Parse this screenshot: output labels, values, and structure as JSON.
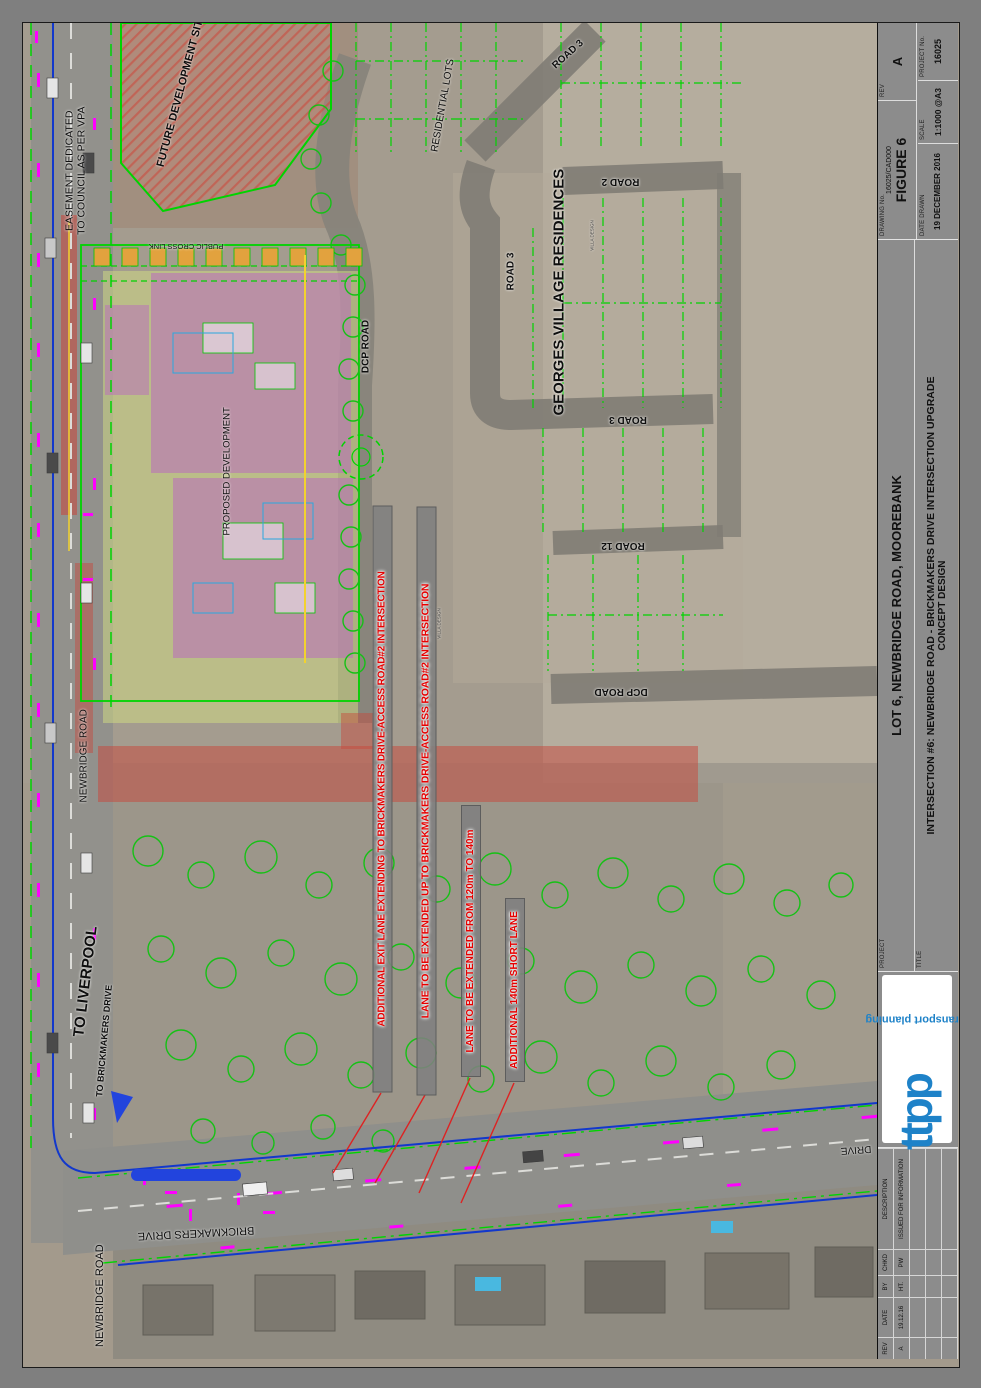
{
  "map": {
    "labels": {
      "easement": "EASEMENT DEDICATED TO COUNCIL AS PER VPA",
      "future_site": "FUTURE DEVELOPMENT SITE",
      "public_cross_link": "PUBLIC CROSS LINK",
      "residential_lots": "RESIDENTIAL LOTS",
      "road3_top": "ROAD 3",
      "road2": "ROAD 2",
      "road3_mid": "ROAD 3",
      "georges": "GEORGES VILLAGE RESIDENCES",
      "road3_low": "ROAD 3",
      "road12": "ROAD 12",
      "dcp_road_east": "DCP ROAD",
      "dcp_road_north": "DCP ROAD",
      "proposed_dev": "PROPOSED DEVELOPMENT",
      "newbridge_mid": "NEWBRIDGE ROAD",
      "to_liverpool": "TO LIVERPOOL",
      "to_brickmakers": "TO BRICKMAKERS DRIVE",
      "brickmakers_drive": "BRICKMAKERS DRIVE",
      "newbridge_bottom": "NEWBRIDGE ROAD",
      "drive_right": "DRIVE",
      "villa_design": "VILLA DESIGN"
    },
    "annotations": [
      {
        "text": "ADDITIONAL EXIT LANE EXTENDING TO BRICKMAKERS DRIVE-ACCESS ROAD#2 INTERSECTION"
      },
      {
        "text": "LANE TO BE EXTENDED UP TO BRICKMAKERS DRIVE-ACCESS ROAD#2 INTERSECTION"
      },
      {
        "text": "LANE TO BE EXTENDED FROM 120m TO 140m"
      },
      {
        "text": "ADDITIONAL 140m SHORT LANE"
      }
    ],
    "colors": {
      "cad_green": "#00d400",
      "annotation_red": "#e60000",
      "magenta": "#ff00ff",
      "blue": "#1238cc",
      "red_overlay": "#c8463c",
      "purple": "#ba6cbe",
      "lime": "#d2de82",
      "orange": "#e2a23e",
      "logo_blue": "#1e82c8"
    }
  },
  "titleblock": {
    "project_label": "PROJECT",
    "project": "LOT 6, NEWBRIDGE ROAD, MOOREBANK",
    "title_label": "TITLE",
    "title_line1": "INTERSECTION #6: NEWBRIDGE ROAD - BRICKMAKERS DRIVE INTERSECTION UPGRADE",
    "title_line2": "CONCEPT DESIGN",
    "drawing_no_label": "DRAWING No.",
    "drawing_no": "16025/CAD000",
    "figure": "FIGURE 6",
    "rev_label": "REV",
    "rev": "A",
    "date_label": "DATE DRAWN",
    "date": "19 DECEMBER 2016",
    "scale_label": "SCALE",
    "scale": "1:1000 @A3",
    "project_no_label": "PROJECT No.",
    "project_no": "16025",
    "logo_text": "ttpp",
    "logo_tagline": "transport planning",
    "revisions": {
      "headers": [
        "REV",
        "DATE",
        "BY",
        "CHKD",
        "DESCRIPTION"
      ],
      "row": [
        "A",
        "19.12.16",
        "HT.",
        "PW",
        "ISSUED FOR INFORMATION"
      ]
    }
  }
}
